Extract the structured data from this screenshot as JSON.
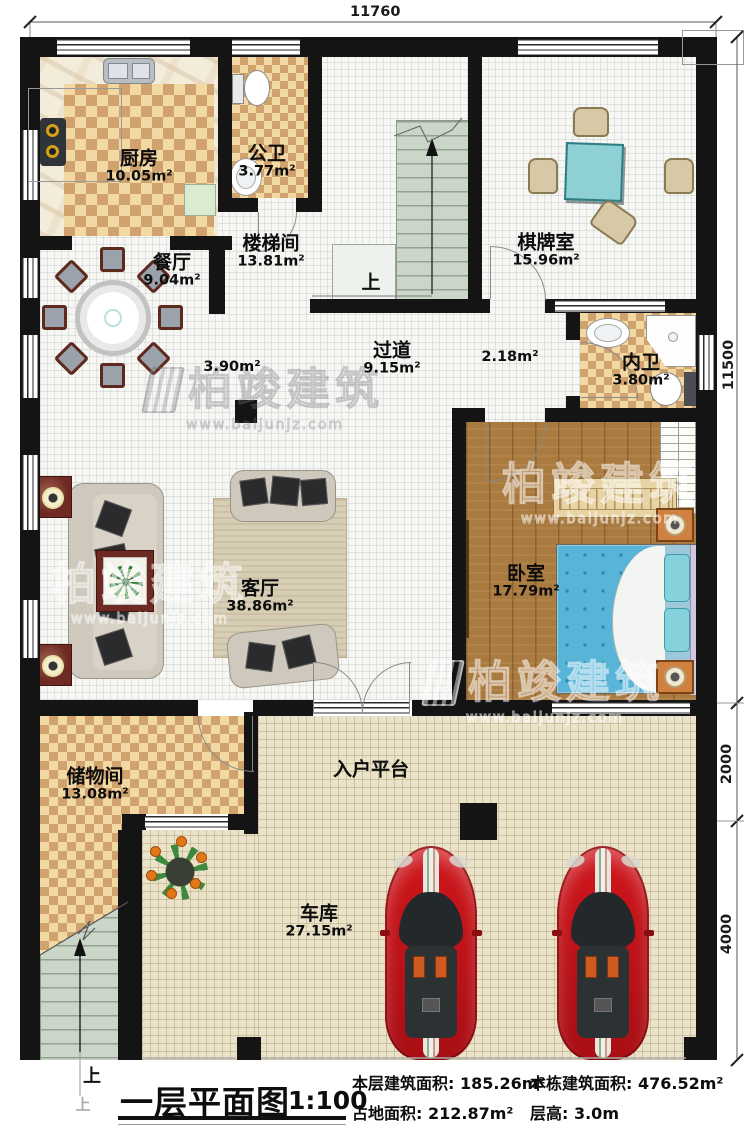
{
  "dimensions": {
    "top": "11760",
    "right_upper": "11500",
    "right_middle": "2000",
    "right_lower": "4000"
  },
  "rooms": {
    "kitchen": {
      "name": "厨房",
      "area": "10.05m²"
    },
    "public_bath": {
      "name": "公卫",
      "area": "3.77m²"
    },
    "stairwell": {
      "name": "楼梯间",
      "area": "13.81m²"
    },
    "chess_room": {
      "name": "棋牌室",
      "area": "15.96m²"
    },
    "dining": {
      "name": "餐厅",
      "area": "9.04m²"
    },
    "hallway": {
      "name": "过道",
      "area": "9.15m²"
    },
    "hallway_sub_left": "3.90m²",
    "hallway_sub_right": "2.18m²",
    "ensuite_bath": {
      "name": "内卫",
      "area": "3.80m²"
    },
    "bedroom": {
      "name": "卧室",
      "area": "17.79m²"
    },
    "living": {
      "name": "客厅",
      "area": "38.86m²"
    },
    "storage": {
      "name": "储物间",
      "area": "13.08m²"
    },
    "entry_platform": {
      "name": "入户平台"
    },
    "garage": {
      "name": "车库",
      "area": "27.15m²"
    }
  },
  "stairs": {
    "up_label": "上",
    "up_label_exterior": "上",
    "up_label_ghost": "上"
  },
  "title_block": {
    "title": "一层平面图",
    "scale": "1:100",
    "stats": [
      {
        "text": "本层建筑面积: 185.26m²"
      },
      {
        "text": "占地面积: 212.87m²"
      },
      {
        "text": "本栋建筑面积: 476.52m²"
      },
      {
        "text": "层高: 3.0m"
      }
    ]
  },
  "watermark": {
    "brand": "柏竣建筑",
    "url": "www.baijunjz.com"
  },
  "colors": {
    "wall": "#141414",
    "checker_light": "#f2d9a4",
    "checker_dark": "#cfa26e",
    "wood": "#aa7b40",
    "garage_floor": "#ebe3c9",
    "stair": "#cbd6c9",
    "bed": "#58b5d8",
    "car": "#c8151c",
    "chess_table": "#8fd0d4"
  }
}
